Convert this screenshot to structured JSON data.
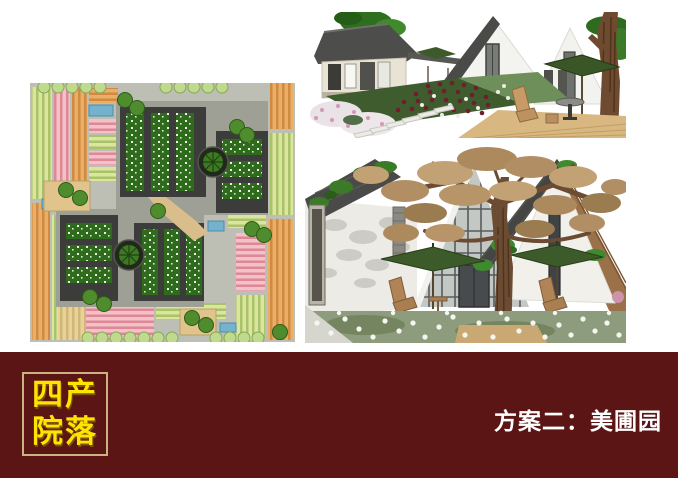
{
  "banner": {
    "bg_color": "#5C1515",
    "logo": {
      "line1": "四产",
      "line2": "院落",
      "text_color": "#FFE400",
      "border_color": "#C9B37E"
    },
    "title": "方案二：美圃园",
    "title_color": "#FFFFFF"
  },
  "figures": {
    "site_plan": {
      "type": "master-plan-illustration",
      "palette": {
        "crop_green": "#DCE5A0",
        "crop_pink": "#F2C2C9",
        "crop_orange": "#EAAE67",
        "path_gray": "#BDBEB4",
        "roof_dark": "#3C3C3A",
        "courtyard_green": "#2F6B1D",
        "pond_blue": "#74B3CE",
        "tree_green": "#4F8C2E"
      }
    },
    "render_top": {
      "type": "3d-rendering",
      "palette": {
        "wall_white": "#F3F3EF",
        "roof_gray": "#4A4A48",
        "rose_red": "#6E1F2E",
        "umbrella_green": "#3A5526",
        "deck_wood": "#D8B781",
        "foliage_green": "#2F6E1E"
      }
    },
    "render_bottom": {
      "type": "3d-rendering",
      "palette": {
        "autumn_leaves": "#B18E63",
        "trunk_brown": "#6B4C33",
        "glass_gray": "#C3C8C4",
        "roof_dark": "#454543",
        "wood_slat": "#9A7148",
        "flower_white": "#F6F6F1"
      }
    }
  }
}
